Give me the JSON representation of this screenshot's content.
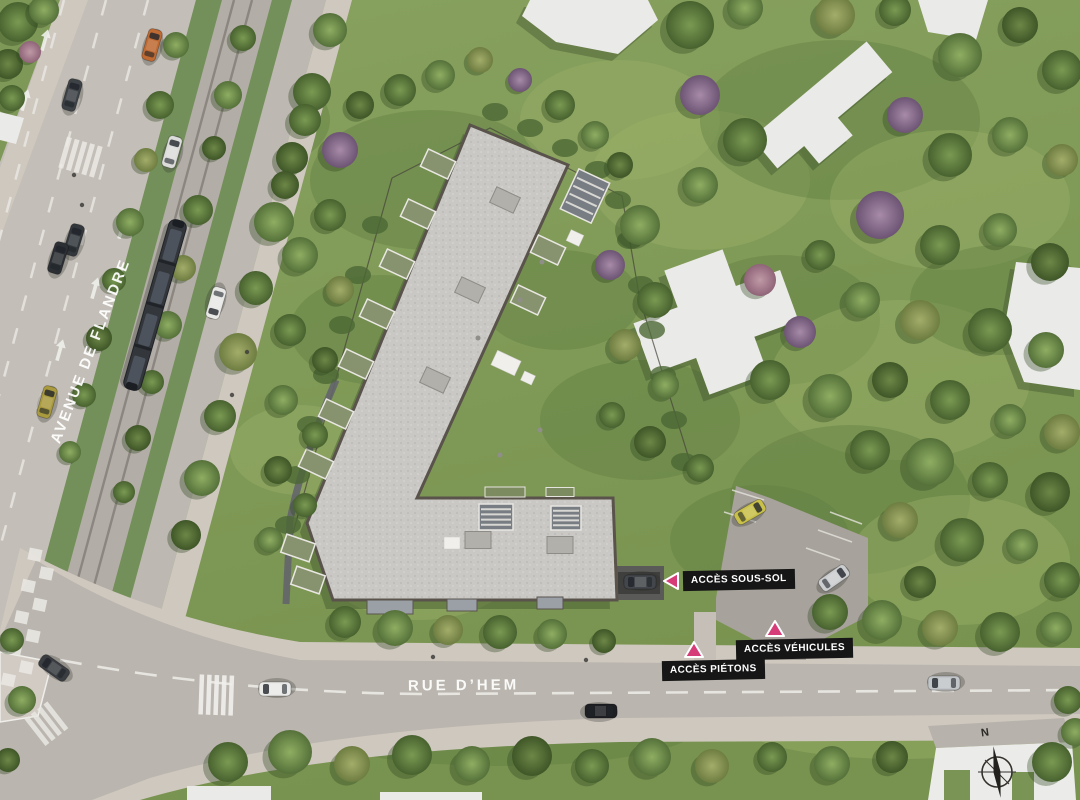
{
  "scene": {
    "kind": "architectural-site-plan-aerial-rendering"
  },
  "streets": {
    "avenue_label": "AVENUE DE FLANDRE",
    "rue_label": "RUE D’HEM"
  },
  "access": {
    "sous_sol": "ACCÈS SOUS-SOL",
    "vehicules": "ACCÈS VÉHICULES",
    "pietons": "ACCÈS PIÉTONS"
  },
  "compass": {
    "north_label": "N"
  },
  "colors": {
    "accent_pink": "#d63c78",
    "label_bg": "#161616",
    "label_text": "#ffffff"
  }
}
